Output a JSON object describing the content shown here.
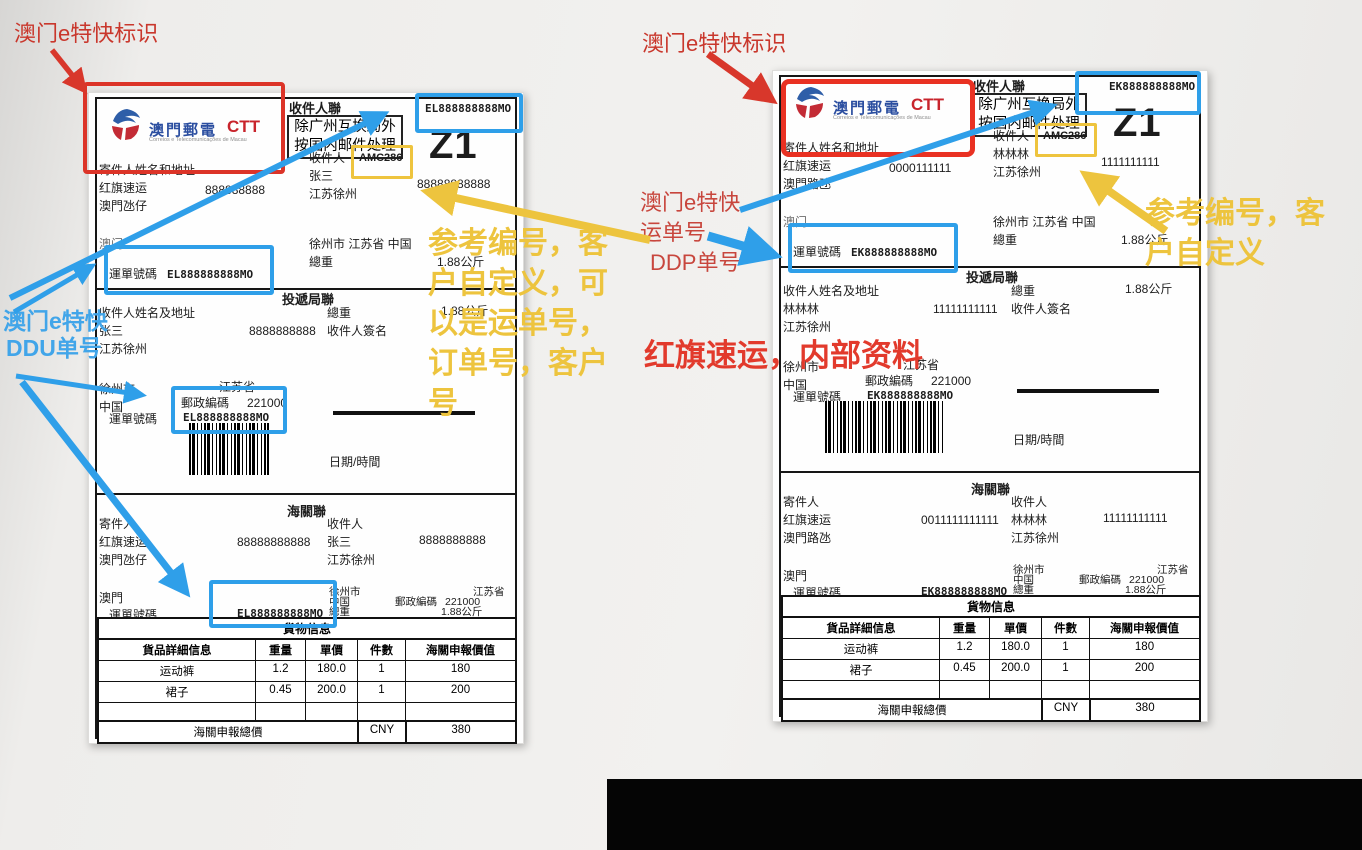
{
  "colors": {
    "annotation_blue": "#2e9fe9",
    "annotation_yellow": "#eec43e",
    "annotation_red": "#dc3428",
    "brand_blue": "#2b4ea0",
    "brand_red": "#c8242c"
  },
  "annotations": {
    "logo_note_left": "澳门e特快标识",
    "logo_note_right": "澳门e特快标识",
    "ddu_note_line1": "澳门e特快",
    "ddu_note_line2": "DDU单号",
    "ddp_note_line1": "澳门e特快",
    "ddp_note_line2": "运单号",
    "ddp_note_line3": "DDP单号",
    "ref_center_line1": "参考编号，客",
    "ref_center_line2": "户自定义，可",
    "ref_center_line3": "以是运单号，",
    "ref_center_line4": "订单号，客户",
    "ref_center_line5": "号",
    "ref_right_line1": "参考编号，客",
    "ref_right_line2": "户自定义",
    "internal_note": "红旗速运，内部资料"
  },
  "labels": [
    {
      "brand": {
        "cn": "澳門郵電",
        "latin": "CTT",
        "sub": "Correios e Telecomunicações de Macau"
      },
      "copy1_title": "收件人聯",
      "notice_line1": "除广州互换局外",
      "notice_line2": "按国内邮件处理",
      "tracking_top": "EL888888888MO",
      "zone_code": "Z1",
      "sender_block_label": "寄件人姓名和地址",
      "sender_name": "红旗速运",
      "sender_phone": "888888888",
      "sender_addr": "澳門氹仔",
      "recipient_label": "收件人",
      "reference_code": "AMC286",
      "recipient_name": "张三",
      "recipient_phone": "88888888888",
      "recipient_addr": "江苏徐州",
      "origin": "澳门",
      "dest_line": "徐州市 江苏省 中国",
      "weight_label": "總重",
      "weight_value": "1.88公斤",
      "waybill_label": "運單號碼",
      "waybill_number": "EL888888888MO",
      "copy2": {
        "title": "投遞局聯",
        "recipient_block_label": "收件人姓名及地址",
        "phone": "8888888888",
        "signature_label": "收件人簽名",
        "city": "徐州市",
        "province": "江苏省",
        "country": "中国",
        "postcode_label": "郵政編碼",
        "postcode": "221000",
        "datetime_label": "日期/時間"
      },
      "copy3": {
        "title": "海關聯",
        "sender_header": "寄件人",
        "recipient_header": "收件人",
        "sender_phone": "88888888888",
        "recipient_phone": "8888888888",
        "origin": "澳門",
        "city": "徐州市",
        "country": "中国",
        "province": "江苏省",
        "postcode_label": "郵政編碼",
        "postcode": "221000"
      },
      "goods": {
        "title": "貨物信息",
        "headers": [
          "貨品詳細信息",
          "重量",
          "單價",
          "件數",
          "海關申報價值"
        ],
        "rows": [
          [
            "运动裤",
            "1.2",
            "180.0",
            "1",
            "180"
          ],
          [
            "裙子",
            "0.45",
            "200.0",
            "1",
            "200"
          ]
        ],
        "total_label": "海關申報總價",
        "currency": "CNY",
        "total_value": "380"
      }
    },
    {
      "brand": {
        "cn": "澳門郵電",
        "latin": "CTT",
        "sub": "Correios e Telecomunicações de Macau"
      },
      "copy1_title": "收件人聯",
      "notice_line1": "除广州互换局外",
      "notice_line2": "按国内邮件处理",
      "tracking_top": "EK888888888MO",
      "zone_code": "Z1",
      "sender_block_label": "寄件人姓名和地址",
      "sender_name": "红旗速运",
      "sender_phone": "0000111111",
      "sender_addr": "澳門路氹",
      "recipient_label": "收件人",
      "reference_code": "AMC286",
      "recipient_name": "林林林",
      "recipient_phone": "1111111111",
      "recipient_addr": "江苏徐州",
      "origin": "澳门",
      "dest_line": "徐州市 江苏省 中国",
      "weight_label": "總重",
      "weight_value": "1.88公斤",
      "waybill_label": "運單號碼",
      "waybill_number": "EK888888888MO",
      "copy2": {
        "title": "投遞局聯",
        "recipient_block_label": "收件人姓名及地址",
        "phone": "11111111111",
        "signature_label": "收件人簽名",
        "city": "徐州市",
        "province": "江苏省",
        "country": "中国",
        "postcode_label": "郵政編碼",
        "postcode": "221000",
        "datetime_label": "日期/時間"
      },
      "copy3": {
        "title": "海關聯",
        "sender_header": "寄件人",
        "recipient_header": "收件人",
        "sender_phone": "0011111111111",
        "recipient_phone": "11111111111",
        "origin": "澳門",
        "city": "徐州市",
        "country": "中国",
        "province": "江苏省",
        "postcode_label": "郵政編碼",
        "postcode": "221000"
      },
      "goods": {
        "title": "貨物信息",
        "headers": [
          "貨品詳細信息",
          "重量",
          "單價",
          "件數",
          "海關申報價值"
        ],
        "rows": [
          [
            "运动裤",
            "1.2",
            "180.0",
            "1",
            "180"
          ],
          [
            "裙子",
            "0.45",
            "200.0",
            "1",
            "200"
          ]
        ],
        "total_label": "海關申報總價",
        "currency": "CNY",
        "total_value": "380"
      }
    }
  ]
}
